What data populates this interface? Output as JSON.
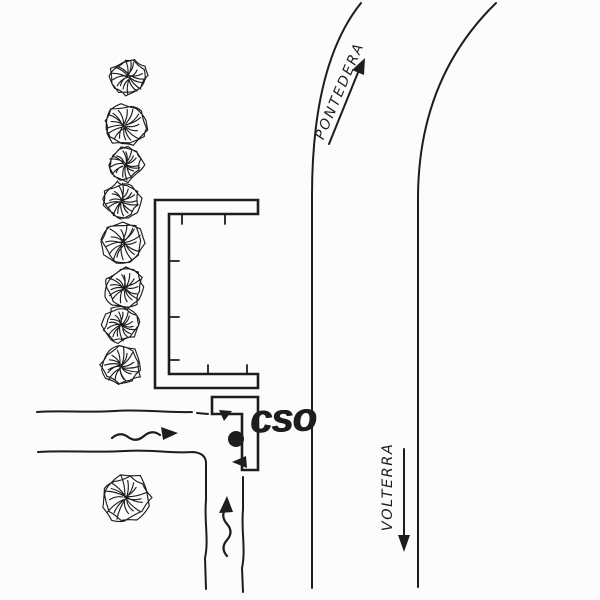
{
  "colors": {
    "ink": "#1d1d1d",
    "paper": "#fcfcfc"
  },
  "labels": {
    "pontedera": "PONTEDERA",
    "volterra": "VOLTERRA",
    "cso": "cso"
  },
  "map": {
    "destination_north": {
      "name": "PONTEDERA",
      "arrow_direction": "up-right"
    },
    "destination_south": {
      "name": "VOLTERRA",
      "arrow_direction": "down"
    },
    "place_marker": {
      "label": "cso",
      "shape": "filled-dot",
      "x": 236,
      "y": 439,
      "r": 8
    },
    "trees": {
      "row": [
        {
          "x": 128,
          "y": 77,
          "r": 19
        },
        {
          "x": 125,
          "y": 126,
          "r": 21
        },
        {
          "x": 125,
          "y": 164,
          "r": 18
        },
        {
          "x": 122,
          "y": 201,
          "r": 19
        },
        {
          "x": 123,
          "y": 243,
          "r": 21
        },
        {
          "x": 124,
          "y": 288,
          "r": 20
        },
        {
          "x": 121,
          "y": 325,
          "r": 18
        },
        {
          "x": 121,
          "y": 366,
          "r": 21
        }
      ],
      "single": {
        "x": 125,
        "y": 498,
        "r": 25
      }
    }
  }
}
